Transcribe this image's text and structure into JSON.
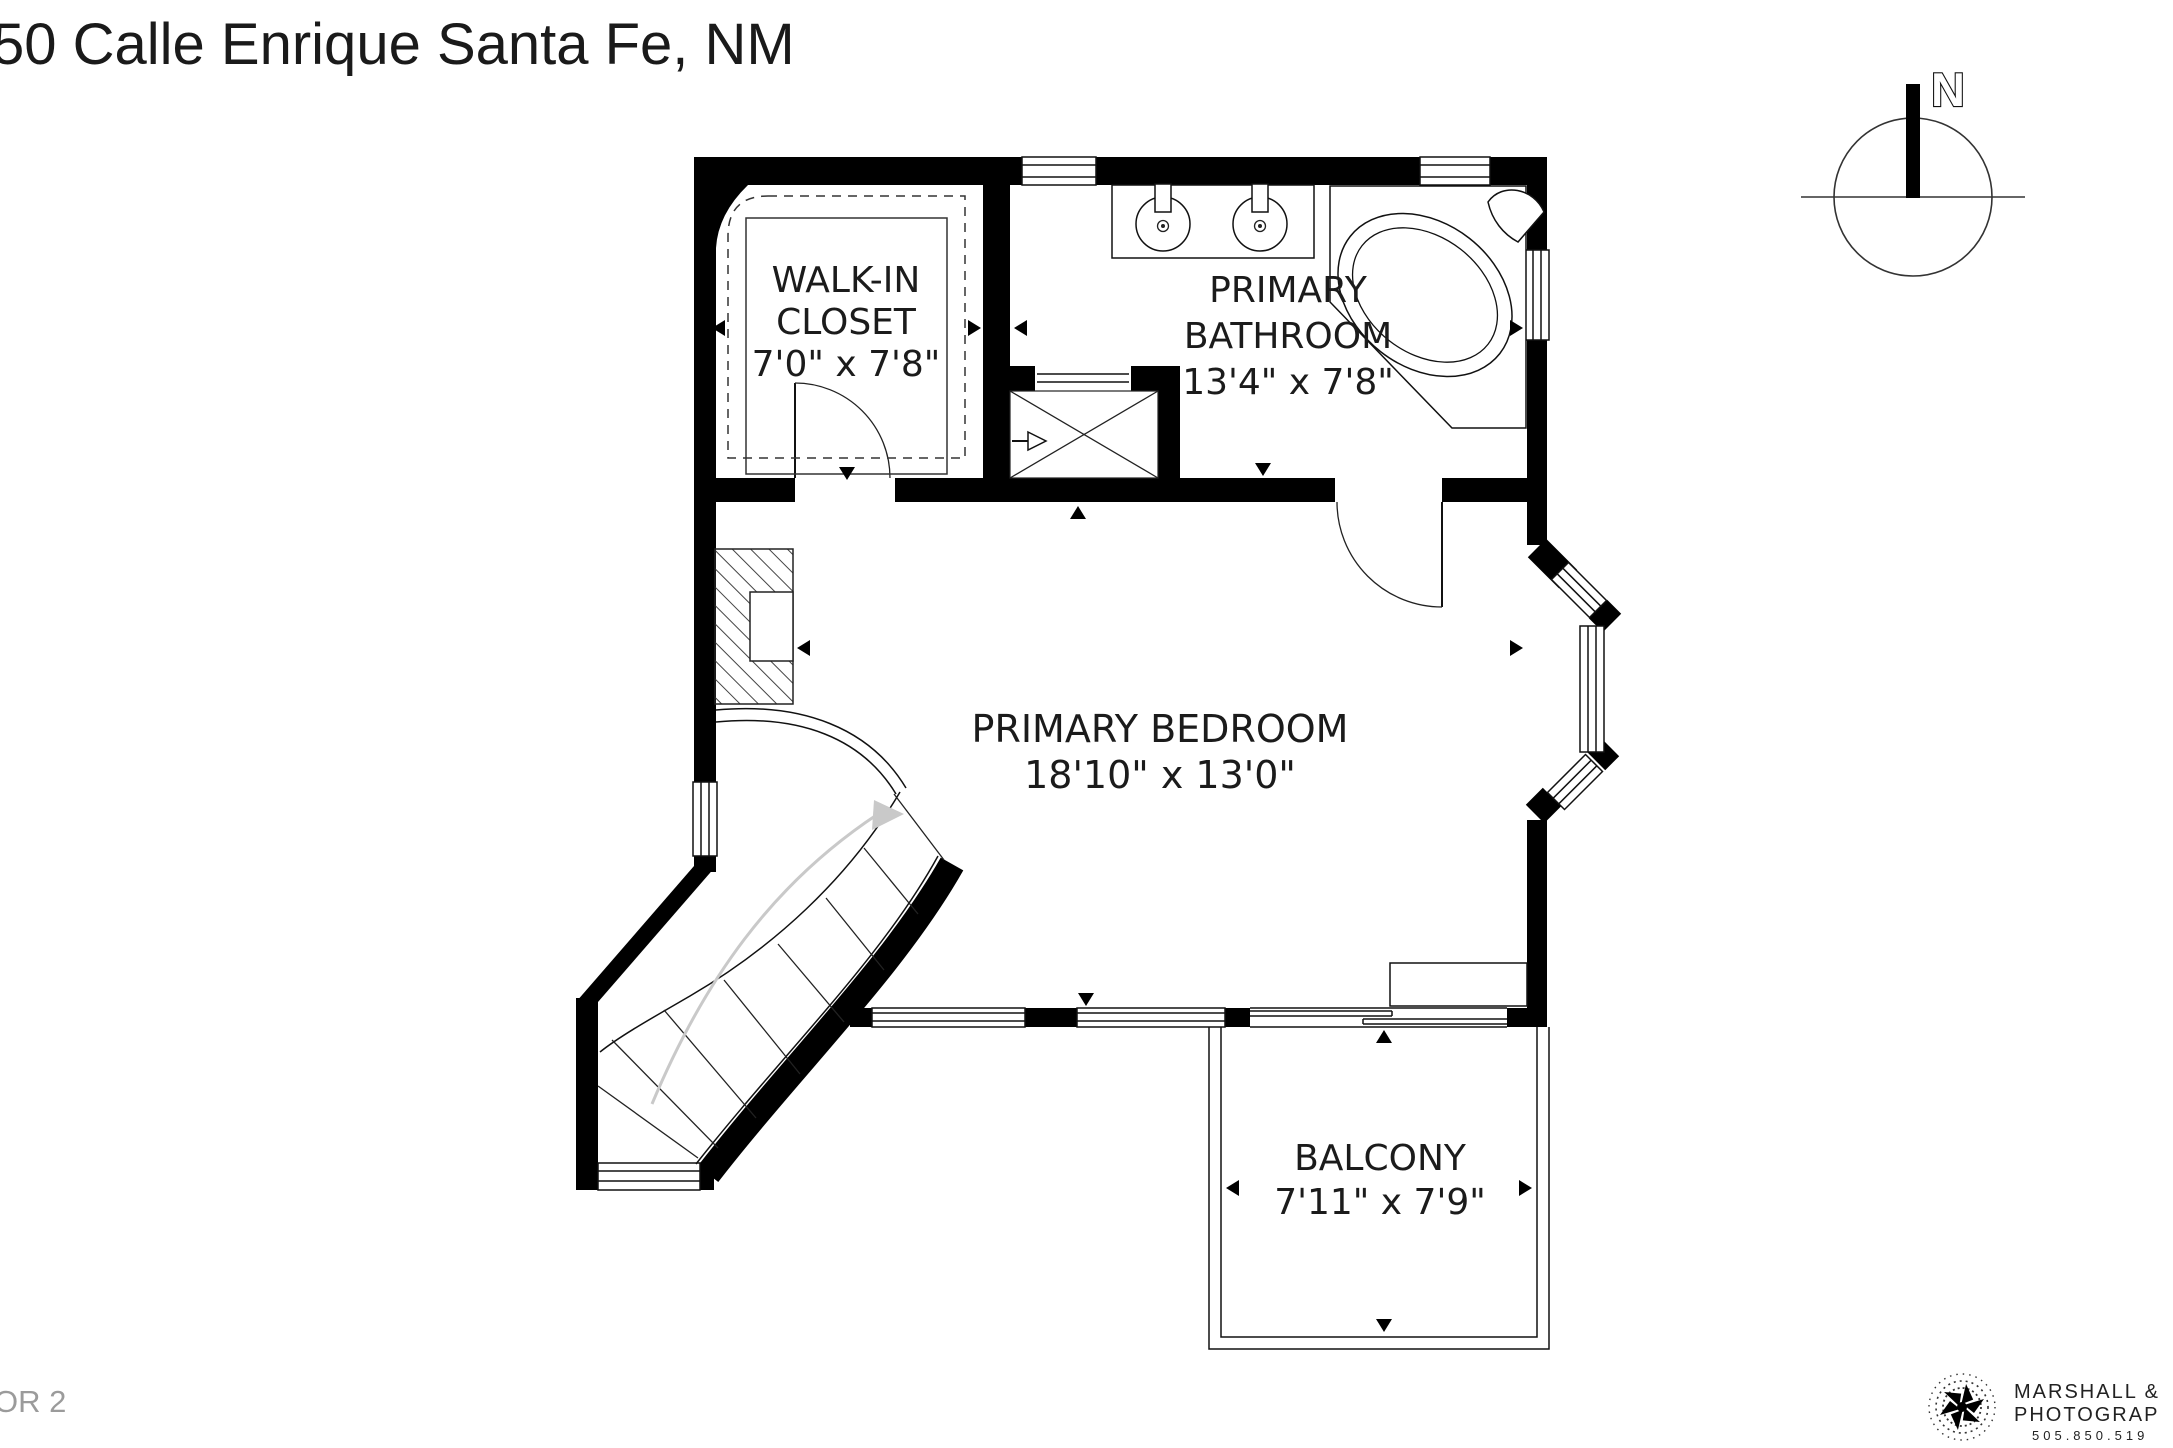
{
  "page": {
    "title": "50 Calle Enrique Santa Fe, NM",
    "floor_label": "OR 2"
  },
  "compass": {
    "label": "N"
  },
  "rooms": {
    "closet": {
      "line1": "WALK-IN",
      "line2": "CLOSET",
      "dims": "7'0\" x 7'8\""
    },
    "bathroom": {
      "line1": "PRIMARY",
      "line2": "BATHROOM",
      "dims": "13'4\" x 7'8\""
    },
    "bedroom": {
      "line1": "PRIMARY BEDROOM",
      "dims": "18'10\" x 13'0\""
    },
    "balcony": {
      "line1": "BALCONY",
      "dims": "7'11\" x 7'9\""
    }
  },
  "branding": {
    "line1": "MARSHALL &",
    "line2": "PHOTOGRAP",
    "line3": "505.850.519"
  },
  "colors": {
    "walls": "#000000",
    "background": "#ffffff",
    "text": "#1b1b1b",
    "floor_label": "#9b9b9b",
    "stair_direction_arrow": "#c9c9c9"
  }
}
